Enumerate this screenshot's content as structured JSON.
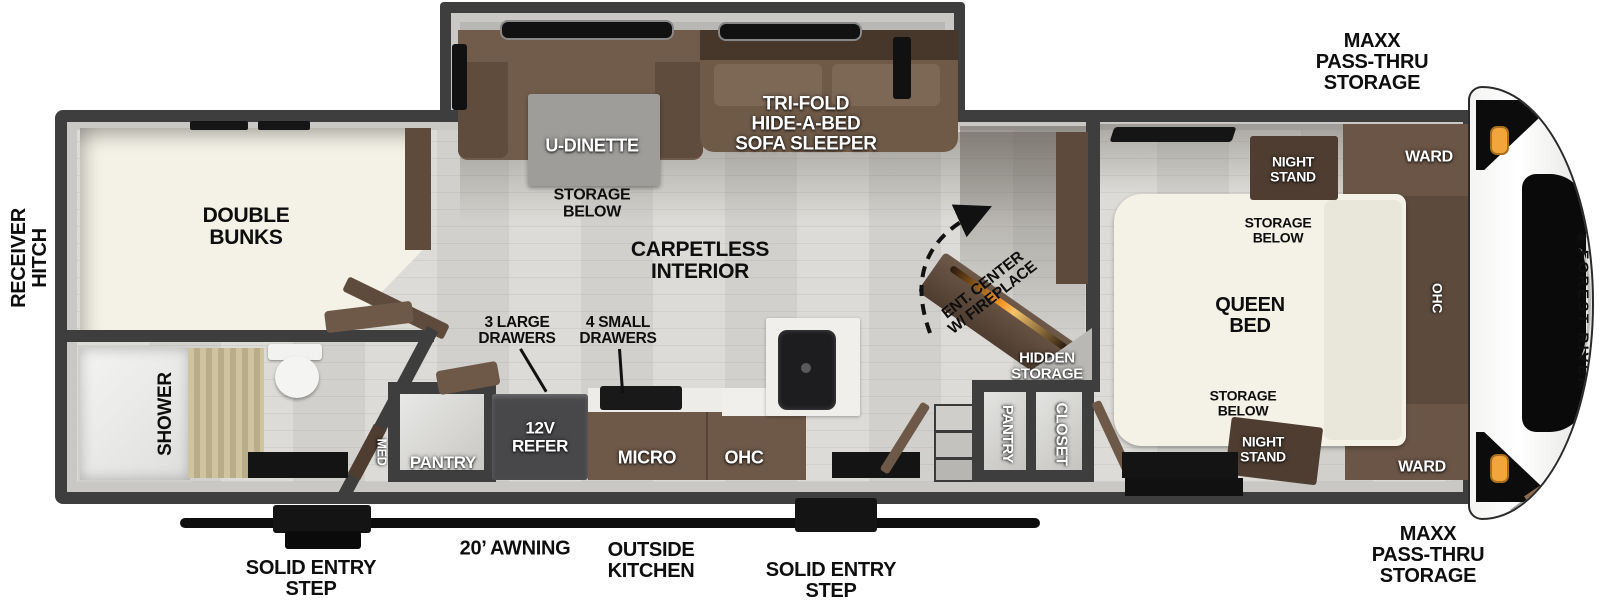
{
  "title": "Forest River travel trailer floor plan",
  "colors": {
    "wall": "#3e3e3e",
    "floor": "#d8d7d3",
    "furniture_brown": "#6e5949",
    "cream": "#f4f2e6",
    "amber_light": "#f2a53b",
    "fireplace_glow": "#f59a2a"
  },
  "exterior": {
    "receiver_hitch": "RECEIVER\nHITCH",
    "maxx_storage_top": "MAXX\nPASS-THRU\nSTORAGE",
    "maxx_storage_bottom": "MAXX\nPASS-THRU\nSTORAGE",
    "awning": "20’ AWNING",
    "outside_kitchen": "OUTSIDE\nKITCHEN",
    "entry_step_left": "SOLID ENTRY\nSTEP",
    "entry_step_right": "SOLID ENTRY\nSTEP",
    "brand": "FOREST RIVER"
  },
  "rear": {
    "double_bunks": "DOUBLE\nBUNKS",
    "shower": "SHOWER",
    "med": "MED",
    "pantry_left": "PANTRY"
  },
  "living": {
    "u_dinette": "U-DINETTE",
    "dinette_storage": "STORAGE\nBELOW",
    "sofa": "TRI-FOLD\nHIDE-A-BED\nSOFA SLEEPER",
    "carpetless": "CARPETLESS\nINTERIOR",
    "ent_center": "ENT. CENTER\nW/ FIREPLACE",
    "hidden_storage": "HIDDEN\nSTORAGE",
    "pantry_right": "PANTRY",
    "closet": "CLOSET"
  },
  "kitchen": {
    "large_drawers": "3 LARGE\nDRAWERS",
    "small_drawers": "4 SMALL\nDRAWERS",
    "refer": "12V\nREFER",
    "micro": "MICRO",
    "ohc": "OHC"
  },
  "bedroom": {
    "queen_bed": "QUEEN\nBED",
    "storage_below_top": "STORAGE\nBELOW",
    "storage_below_bottom": "STORAGE\nBELOW",
    "night_stand_top": "NIGHT\nSTAND",
    "night_stand_bottom": "NIGHT\nSTAND",
    "ward_top": "WARD",
    "ward_bottom": "WARD",
    "ohc": "OHC"
  }
}
